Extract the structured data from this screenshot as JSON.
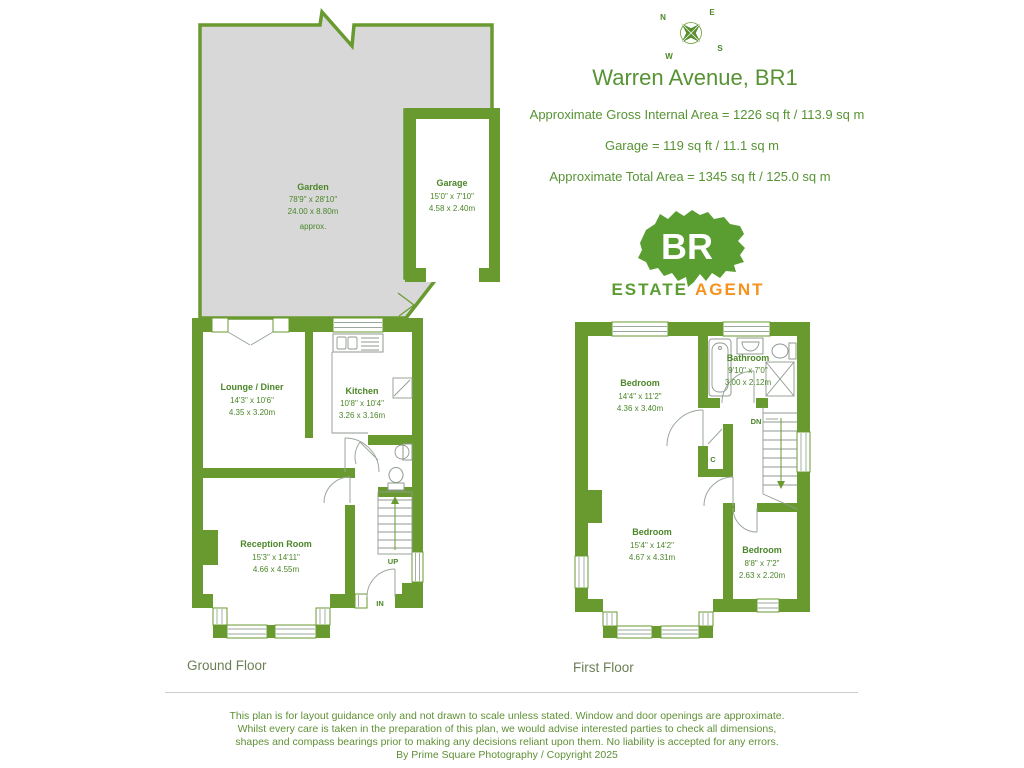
{
  "header": {
    "title": "Warren Avenue, BR1",
    "gross_area": "Approximate Gross Internal Area = 1226 sq ft / 113.9 sq m",
    "garage_area": "Garage = 119 sq ft / 11.1 sq m",
    "total_area": "Approximate Total Area = 1345 sq ft / 125.0 sq m"
  },
  "compass": {
    "n": "N",
    "e": "E",
    "s": "S",
    "w": "W"
  },
  "logo": {
    "initials": "BR",
    "estate_label": "ESTATE",
    "agent_label": "AGENT"
  },
  "garden": {
    "name": "Garden",
    "dims_ft": "78'9\" x 28'10\"",
    "dims_m": "24.00 x 8.80m",
    "approx": "approx."
  },
  "garage": {
    "name": "Garage",
    "dims_ft": "15'0\" x 7'10\"",
    "dims_m": "4.58 x 2.40m"
  },
  "ground_floor": {
    "label": "Ground Floor",
    "lounge": {
      "name": "Lounge / Diner",
      "dims_ft": "14'3\" x 10'6\"",
      "dims_m": "4.35 x 3.20m"
    },
    "kitchen": {
      "name": "Kitchen",
      "dims_ft": "10'8\" x 10'4\"",
      "dims_m": "3.26 x 3.16m"
    },
    "reception": {
      "name": "Reception Room",
      "dims_ft": "15'3\" x 14'11\"",
      "dims_m": "4.66 x 4.55m"
    },
    "up_label": "UP",
    "in_label": "IN"
  },
  "first_floor": {
    "label": "First Floor",
    "bedroom1": {
      "name": "Bedroom",
      "dims_ft": "14'4\" x 11'2\"",
      "dims_m": "4.36 x 3.40m"
    },
    "bathroom": {
      "name": "Bathroom",
      "dims_ft": "9'10\" x 7'0\"",
      "dims_m": "3.00 x 2.12m"
    },
    "bedroom2": {
      "name": "Bedroom",
      "dims_ft": "15'4\" x 14'2\"",
      "dims_m": "4.67 x 4.31m"
    },
    "bedroom3": {
      "name": "Bedroom",
      "dims_ft": "8'8\" x 7'2\"",
      "dims_m": "2.63 x 2.20m"
    },
    "down_label": "DN",
    "cupboard_label": "C"
  },
  "footer": {
    "line1": "This plan is for layout guidance only and not drawn to scale unless stated. Window and door openings are approximate.",
    "line2": "Whilst every care is taken in the preparation of this plan, we would advise interested parties to check all dimensions,",
    "line3": "shapes and compass bearings prior to making any decisions reliant upon them. No liability is accepted for any errors.",
    "credit": "By Prime Square Photography / Copyright 2025"
  },
  "colors": {
    "wall_green": "#699a2f",
    "text_green": "#4b8628",
    "title_green": "#579334",
    "garden_gray": "#d8d8d8",
    "logo_green": "#5a9e31",
    "agent_orange": "#f6921e"
  }
}
